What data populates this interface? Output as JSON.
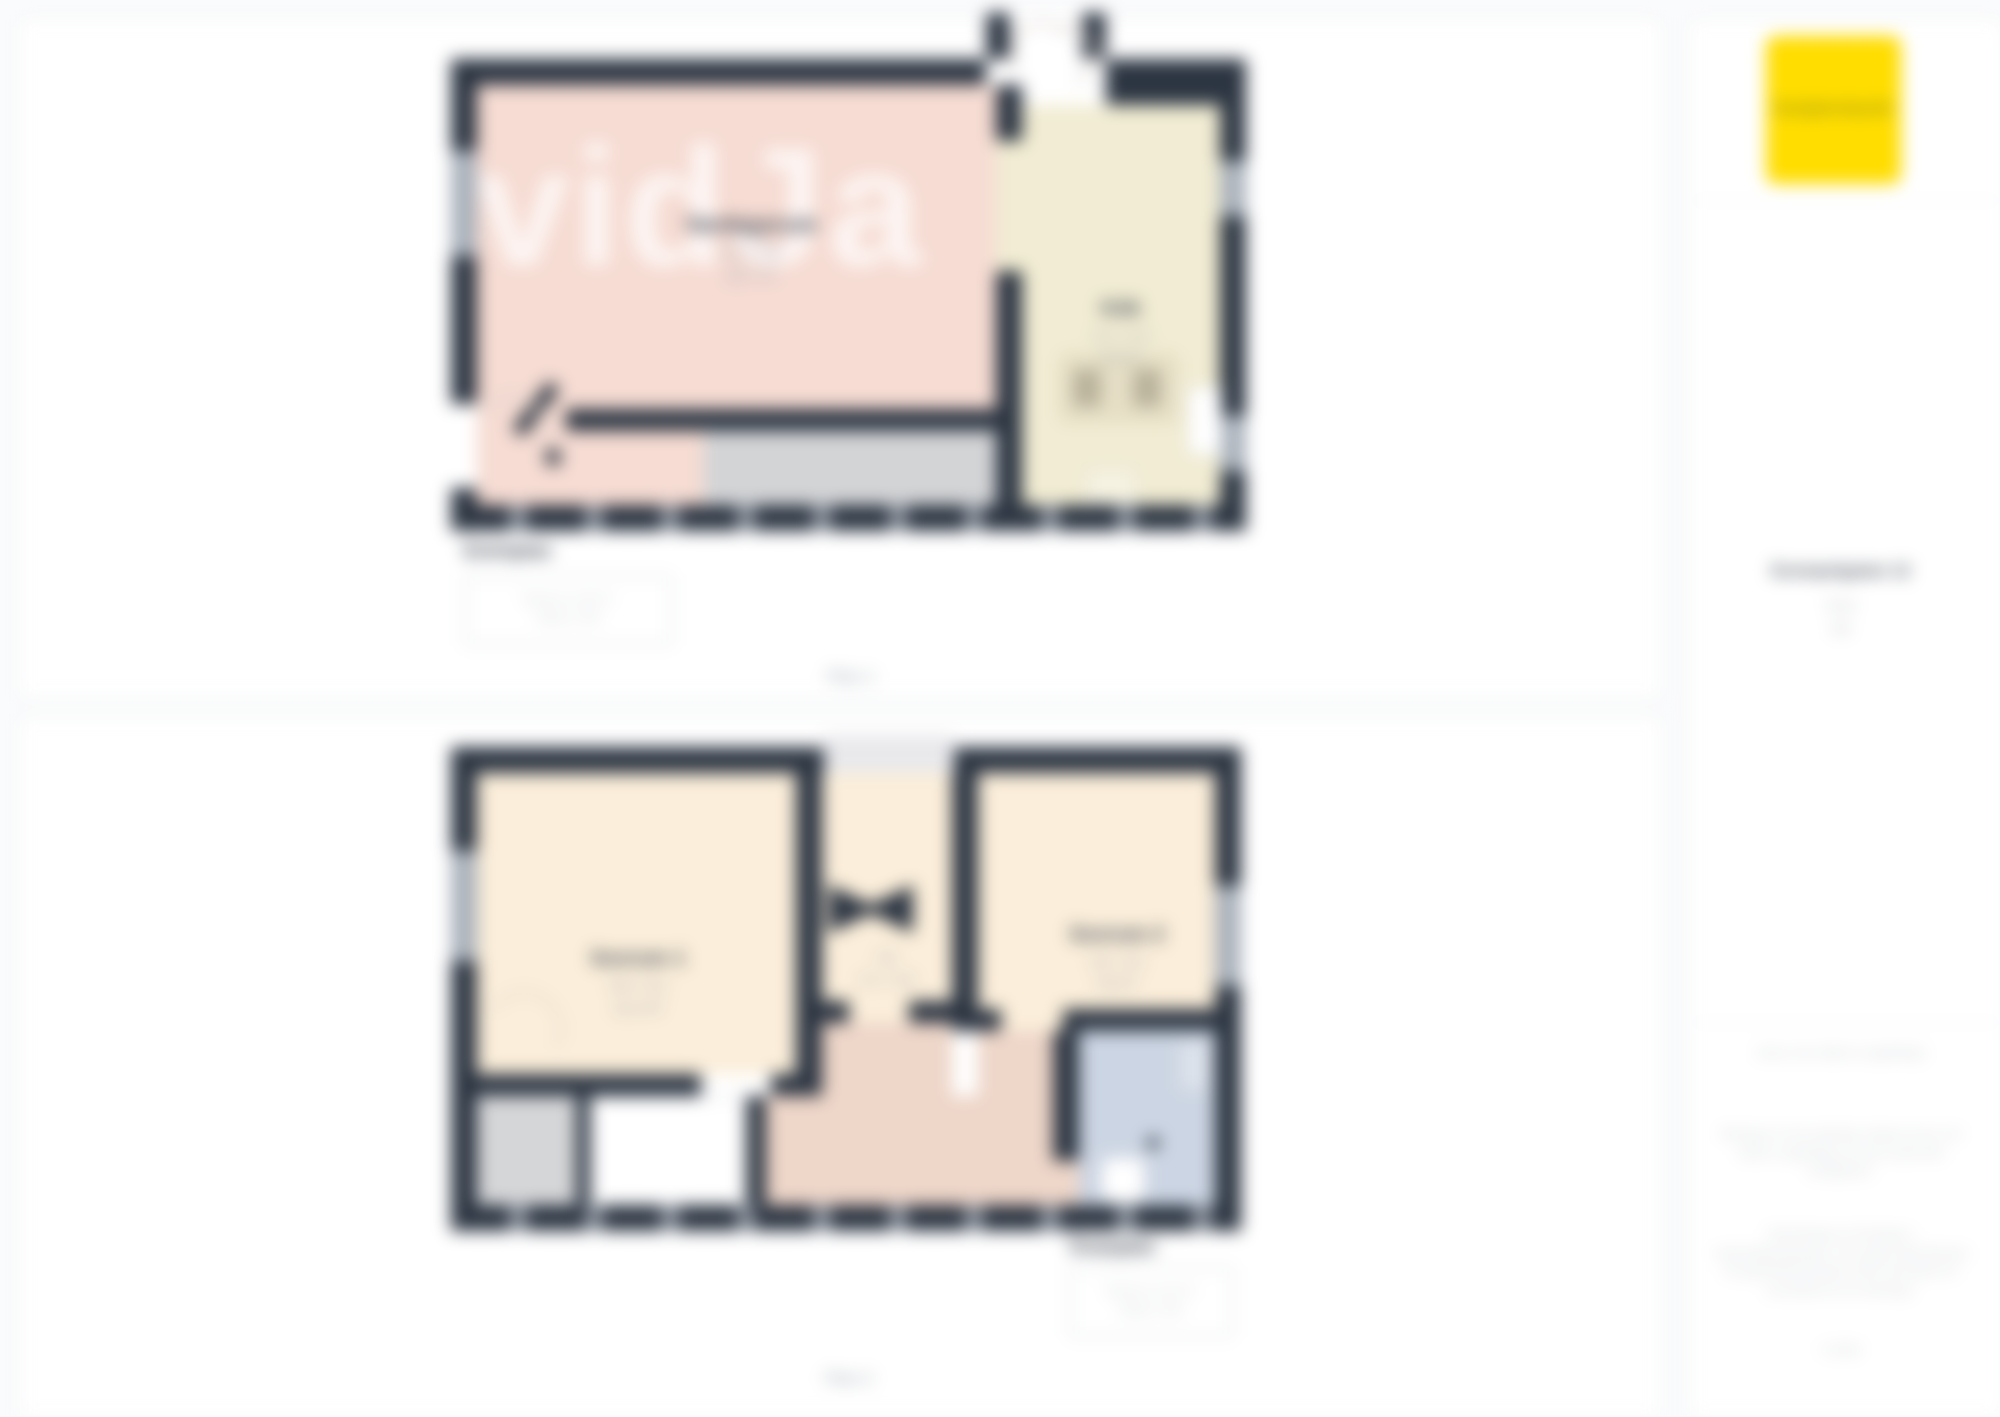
{
  "brand": {
    "logo_text": "fastighetsbyrån",
    "logo_color": "#FFDD00"
  },
  "plan1": {
    "watermark": "vidJa",
    "page_label": "Plan 1",
    "caption": {
      "title": "Entréplan",
      "line1": "Boarea ca 28 m²",
      "line2": "Skala 1:100"
    },
    "rooms": {
      "living": {
        "name": "Vardagsrum",
        "dim1": "5,2 × 3,6",
        "dim2": "18,7 m²"
      },
      "kitchen": {
        "name": "Kök",
        "dim1": "4,1 × 2,3",
        "dim2": "9,4 m²"
      }
    }
  },
  "plan2": {
    "page_label": "Plan 2",
    "caption": {
      "title": "Ovanplan",
      "line1": "Boarea ca 42 m²",
      "line2": "Skala 1:100"
    },
    "rooms": {
      "bedroom1": {
        "name": "Sovrum 1",
        "dim1": "3,6 × 3,1",
        "dim2": "11,2 m²"
      },
      "closet": {
        "name": "Klk",
        "dim1": "2,1 × 2,6"
      },
      "bedroom2": {
        "name": "Sovrum 2",
        "dim1": "3,0 × 3,2",
        "dim2": "9,6 m²"
      },
      "bathroom": {
        "name": "Bad"
      }
    }
  },
  "sidebar": {
    "address": "Exempelgatan 12",
    "area": "70 m²",
    "floor": "2 tr",
    "note": "Areor och mått är ungefärliga",
    "para1": "Ritningen är inte skalenlig. Angivna areor och mått är ungefärliga och kan avvika från verkligheten.",
    "para2": "Planritningen är framtagen i marknadsföringssyfte. För exakta mått hänvisas till uppmätning på plats. Med reservation för eventuella fel och ändringar.",
    "footer": "© 2024"
  }
}
